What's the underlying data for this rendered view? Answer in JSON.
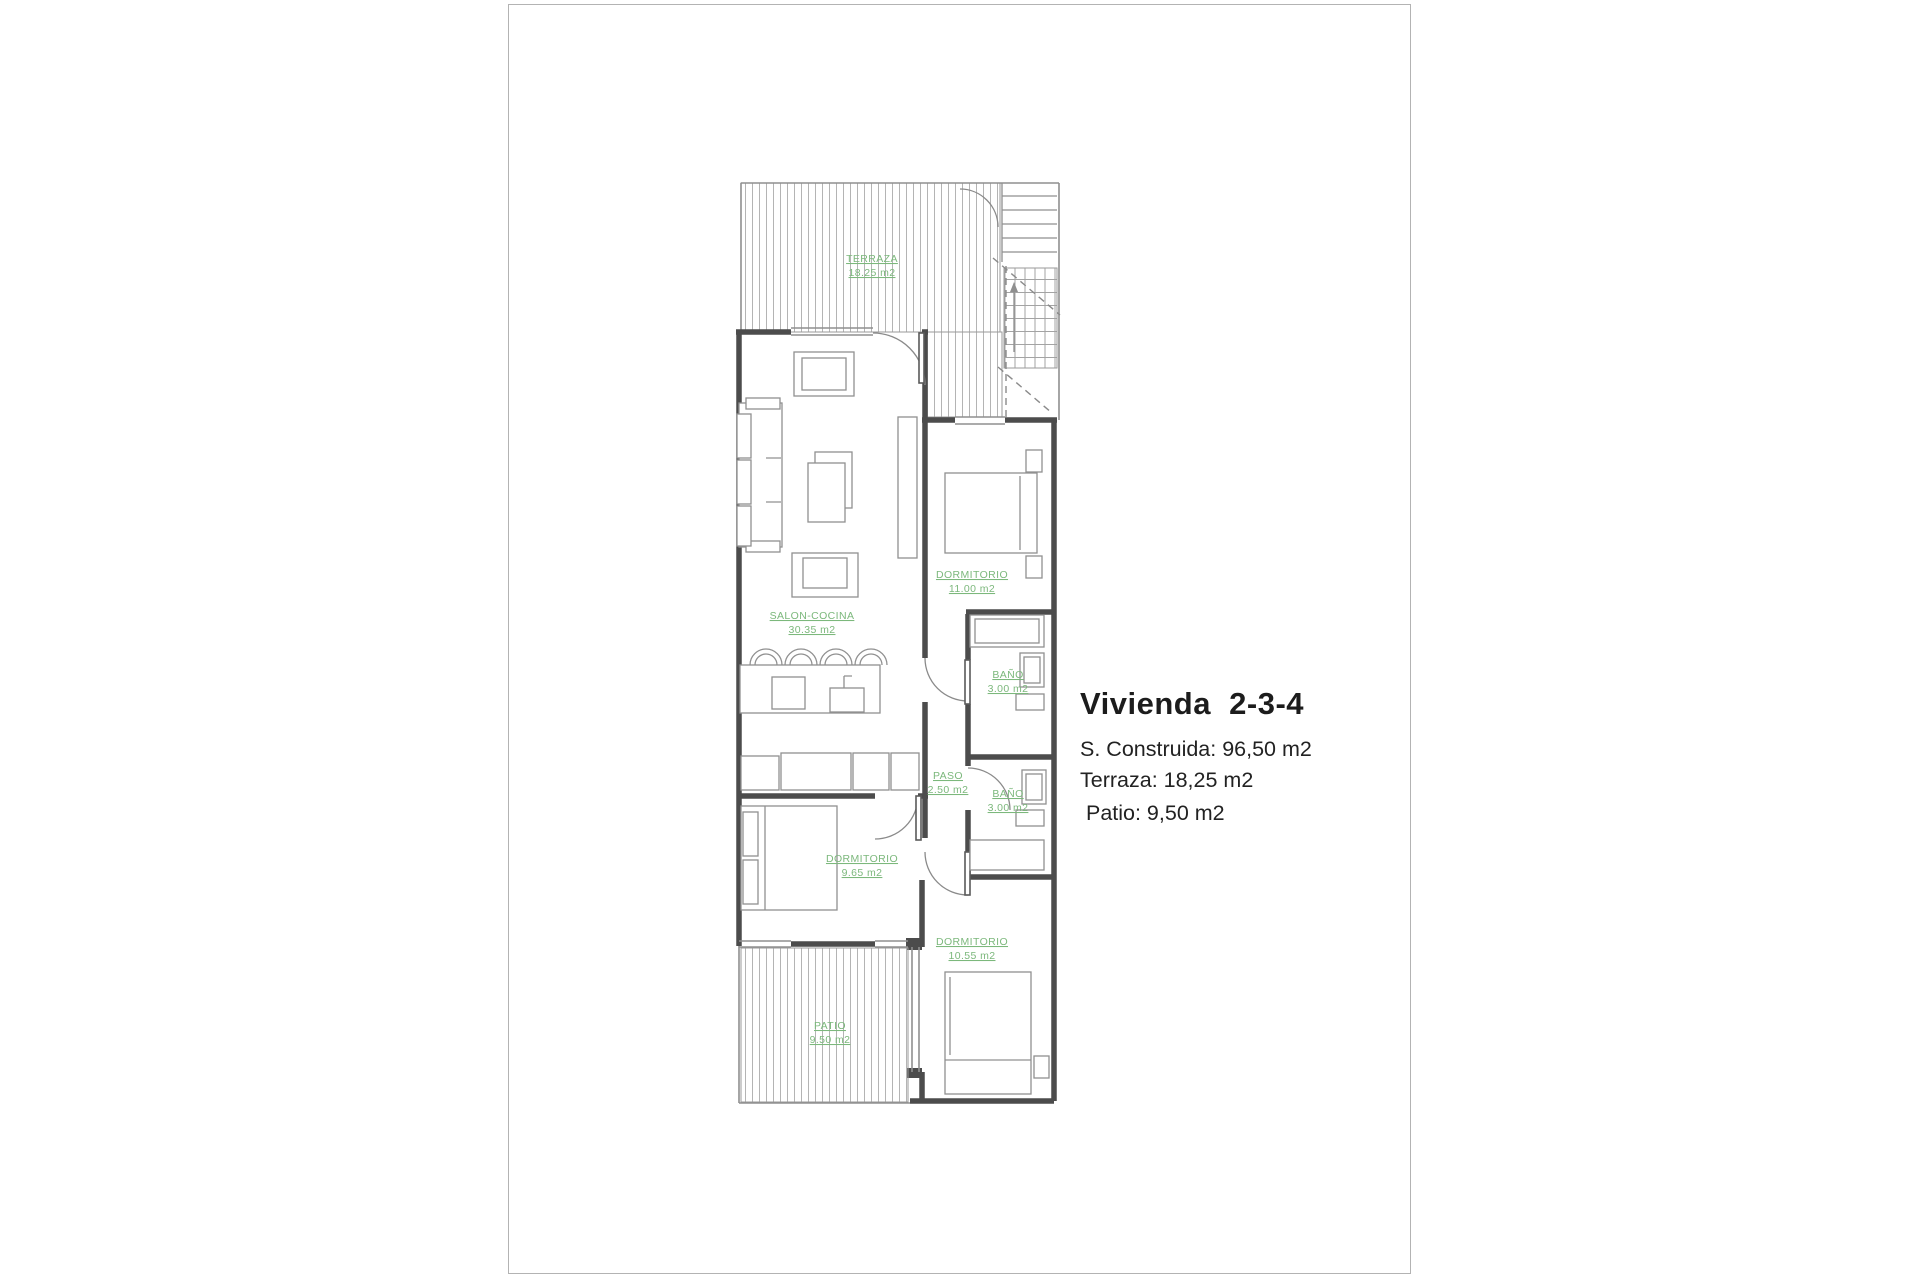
{
  "page": {
    "background": "#ffffff",
    "border_color": "#b3b3b3"
  },
  "plan": {
    "colors": {
      "wall": "#4c4c4c",
      "thin_line": "#8f8f8f",
      "hatch": "#b4b4b4",
      "room_label": "#7cb87c"
    },
    "rooms": [
      {
        "id": "terraza",
        "name": "TERRAZA",
        "area": "18.25 m2"
      },
      {
        "id": "salon",
        "name": "SALON-COCINA",
        "area": "30.35 m2"
      },
      {
        "id": "dormitorio1",
        "name": "DORMITORIO",
        "area": "11.00 m2"
      },
      {
        "id": "bano1",
        "name": "BAÑO",
        "area": "3.00 m2"
      },
      {
        "id": "paso",
        "name": "PASO",
        "area": "2.50 m2"
      },
      {
        "id": "bano2",
        "name": "BAÑO",
        "area": "3.00 m2"
      },
      {
        "id": "dormitorio2",
        "name": "DORMITORIO",
        "area": "9.65 m2"
      },
      {
        "id": "dormitorio3",
        "name": "DORMITORIO",
        "area": "10.55 m2"
      },
      {
        "id": "patio",
        "name": "PATIO",
        "area": "9.50 m2"
      }
    ]
  },
  "info": {
    "title": "Vivienda  2-3-4",
    "text_color": "#1f1f1f",
    "lines": [
      "S. Construida: 96,50 m2",
      "Terraza: 18,25 m2",
      " Patio: 9,50 m2"
    ]
  }
}
